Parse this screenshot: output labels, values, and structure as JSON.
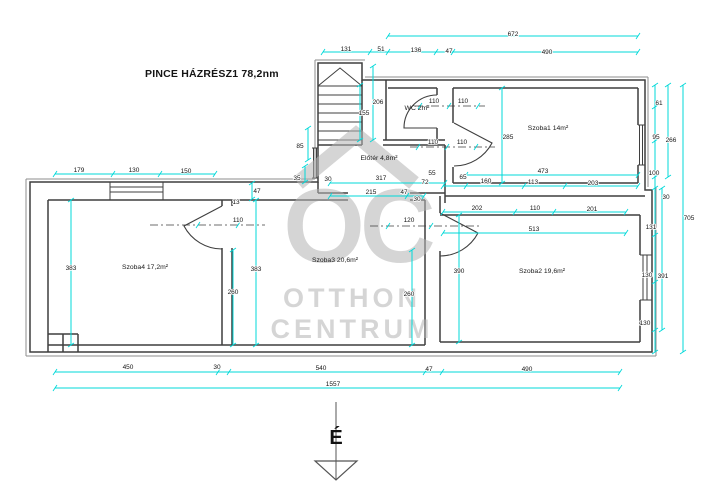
{
  "title": "PINCE HÁZRÉSZ1 78,2nm",
  "watermark": {
    "monogram": "OC",
    "line1": "OTTHON",
    "line2": "CENTRUM"
  },
  "compass": {
    "label": "É"
  },
  "colors": {
    "dimension_line": "#00d9d9",
    "wall": "#3f3f3f",
    "outer_wall_accent": "#8d8d8d",
    "watermark_gray": "#b4b4b4",
    "background": "#ffffff"
  },
  "rooms": [
    {
      "label": "Szoba1 14m²",
      "x": 548,
      "y": 130
    },
    {
      "label": "Szoba2 19,6m²",
      "x": 542,
      "y": 273
    },
    {
      "label": "Szoba3 20,6m²",
      "x": 335,
      "y": 262
    },
    {
      "label": "Szoba4 17,2m²",
      "x": 145,
      "y": 269
    },
    {
      "label": "WC 2m²",
      "x": 417,
      "y": 110
    },
    {
      "label": "Előtér 4,8m²",
      "x": 379,
      "y": 160
    }
  ],
  "dimension_labels": [
    {
      "t": "672",
      "x": 513,
      "y": 36
    },
    {
      "t": "131",
      "x": 346,
      "y": 51
    },
    {
      "t": "51",
      "x": 381,
      "y": 51
    },
    {
      "t": "136",
      "x": 416,
      "y": 52
    },
    {
      "t": "47",
      "x": 449,
      "y": 53
    },
    {
      "t": "490",
      "x": 547,
      "y": 54
    },
    {
      "t": "179",
      "x": 79,
      "y": 172
    },
    {
      "t": "130",
      "x": 134,
      "y": 172
    },
    {
      "t": "150",
      "x": 186,
      "y": 173
    },
    {
      "t": "206",
      "x": 378,
      "y": 104
    },
    {
      "t": "155",
      "x": 364,
      "y": 115
    },
    {
      "t": "110",
      "x": 434,
      "y": 103
    },
    {
      "t": "110",
      "x": 463,
      "y": 103
    },
    {
      "t": "85",
      "x": 300,
      "y": 148
    },
    {
      "t": "35",
      "x": 297,
      "y": 180
    },
    {
      "t": "30",
      "x": 328,
      "y": 181
    },
    {
      "t": "317",
      "x": 381,
      "y": 180
    },
    {
      "t": "215",
      "x": 371,
      "y": 194
    },
    {
      "t": "47",
      "x": 404,
      "y": 194
    },
    {
      "t": "30",
      "x": 417,
      "y": 201
    },
    {
      "t": "72",
      "x": 425,
      "y": 184
    },
    {
      "t": "55",
      "x": 432,
      "y": 175
    },
    {
      "t": "65",
      "x": 463,
      "y": 179
    },
    {
      "t": "160",
      "x": 486,
      "y": 183
    },
    {
      "t": "113",
      "x": 533,
      "y": 184
    },
    {
      "t": "203",
      "x": 593,
      "y": 185
    },
    {
      "t": "473",
      "x": 543,
      "y": 173
    },
    {
      "t": "110",
      "x": 433,
      "y": 144
    },
    {
      "t": "110",
      "x": 462,
      "y": 144
    },
    {
      "t": "47",
      "x": 257,
      "y": 193
    },
    {
      "t": "13",
      "x": 236,
      "y": 204
    },
    {
      "t": "110",
      "x": 238,
      "y": 222
    },
    {
      "t": "120",
      "x": 409,
      "y": 222
    },
    {
      "t": "285",
      "x": 508,
      "y": 139
    },
    {
      "t": "202",
      "x": 477,
      "y": 210
    },
    {
      "t": "110",
      "x": 535,
      "y": 210
    },
    {
      "t": "201",
      "x": 592,
      "y": 211
    },
    {
      "t": "513",
      "x": 534,
      "y": 231
    },
    {
      "t": "383",
      "x": 71,
      "y": 270
    },
    {
      "t": "383",
      "x": 256,
      "y": 271
    },
    {
      "t": "260",
      "x": 233,
      "y": 294
    },
    {
      "t": "260",
      "x": 409,
      "y": 296
    },
    {
      "t": "390",
      "x": 459,
      "y": 273
    },
    {
      "t": "61",
      "x": 659,
      "y": 105
    },
    {
      "t": "95",
      "x": 656,
      "y": 139
    },
    {
      "t": "266",
      "x": 671,
      "y": 142
    },
    {
      "t": "100",
      "x": 654,
      "y": 175
    },
    {
      "t": "30",
      "x": 666,
      "y": 199
    },
    {
      "t": "131",
      "x": 651,
      "y": 229
    },
    {
      "t": "705",
      "x": 689,
      "y": 220
    },
    {
      "t": "130",
      "x": 647,
      "y": 277
    },
    {
      "t": "391",
      "x": 663,
      "y": 278
    },
    {
      "t": "130",
      "x": 645,
      "y": 325
    },
    {
      "t": "450",
      "x": 128,
      "y": 369
    },
    {
      "t": "30",
      "x": 217,
      "y": 369
    },
    {
      "t": "540",
      "x": 321,
      "y": 370
    },
    {
      "t": "47",
      "x": 429,
      "y": 371
    },
    {
      "t": "490",
      "x": 527,
      "y": 371
    },
    {
      "t": "1557",
      "x": 333,
      "y": 386
    }
  ]
}
